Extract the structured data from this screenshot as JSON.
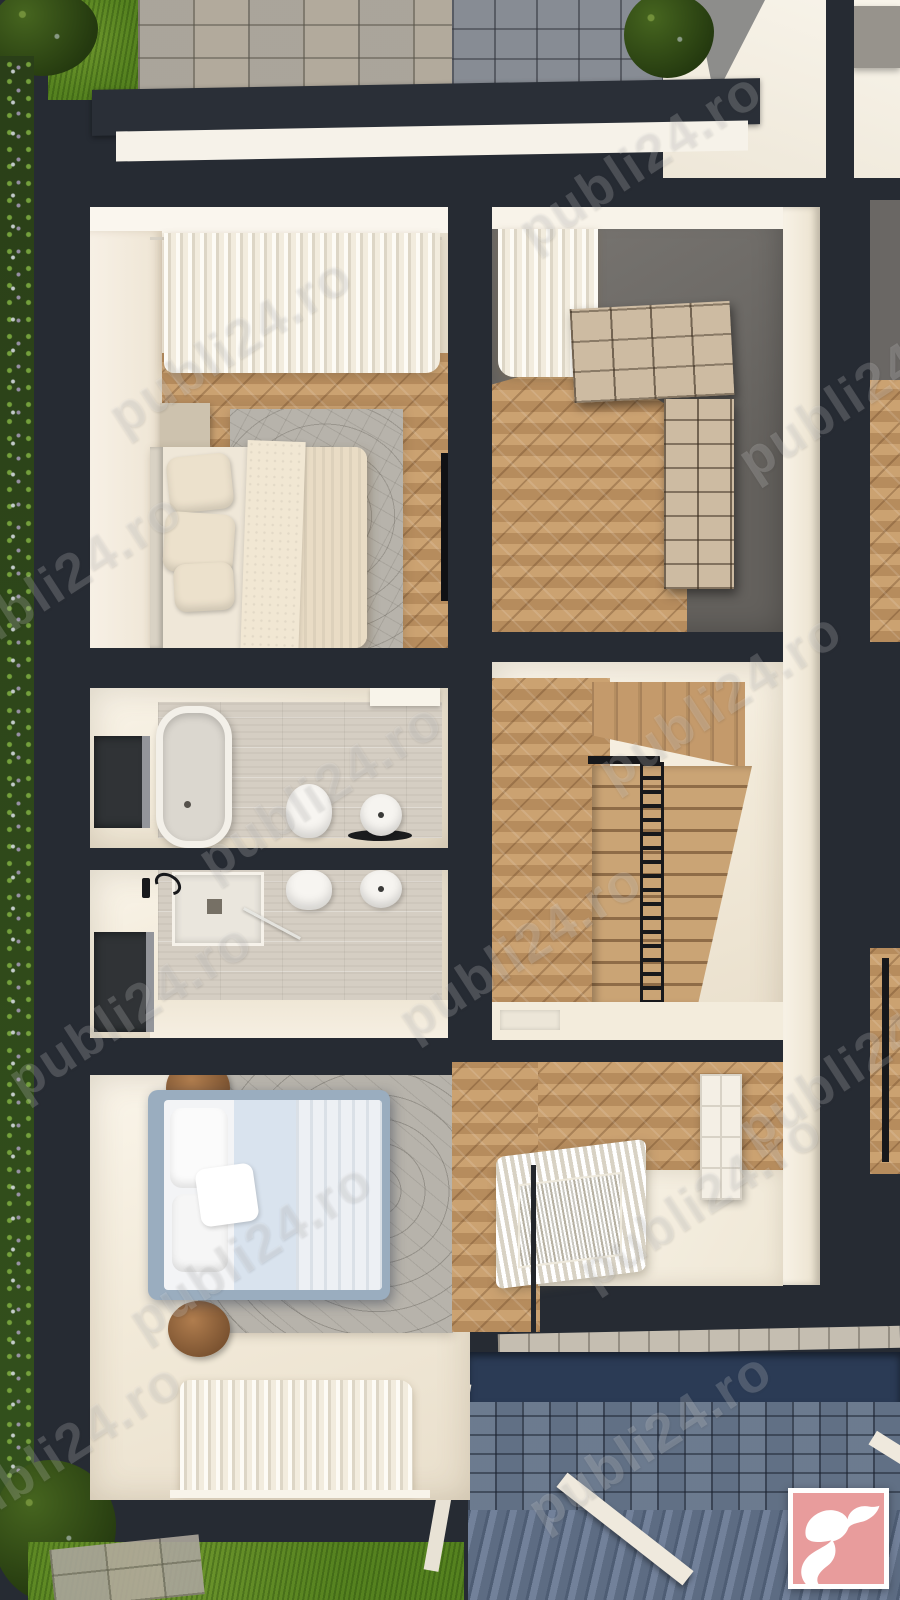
{
  "watermark": {
    "text": "publi24.ro"
  },
  "logo": {
    "name": "publi24-bird-logo"
  },
  "palette": {
    "wall_dark": "#262b33",
    "cream": "#f2ead9",
    "cream_bright": "#faf5ea",
    "cream_shadow": "#e4d9c6",
    "wood": "#c2996a",
    "wood_dark": "#8f6c47",
    "wood_light": "#d6b182",
    "gray_wall": "#6f6c68",
    "rug_gray": "#b7b3ab",
    "tile": "#d5cec3",
    "bed_blue_frame": "#9aadbf",
    "bed_white": "#f3f4f6",
    "stool_brown": "#96693f",
    "grass": "#55821f",
    "foliage_dark": "#2c421a",
    "pavers_light": "#b2aa9c",
    "pavers_blue": "#617085",
    "paver_navy": "#2b3b55",
    "stone_band": "#c5beb1",
    "railing_black": "#17181b",
    "logo_pink": "#e89c9c",
    "logo_white": "#ffffff"
  }
}
